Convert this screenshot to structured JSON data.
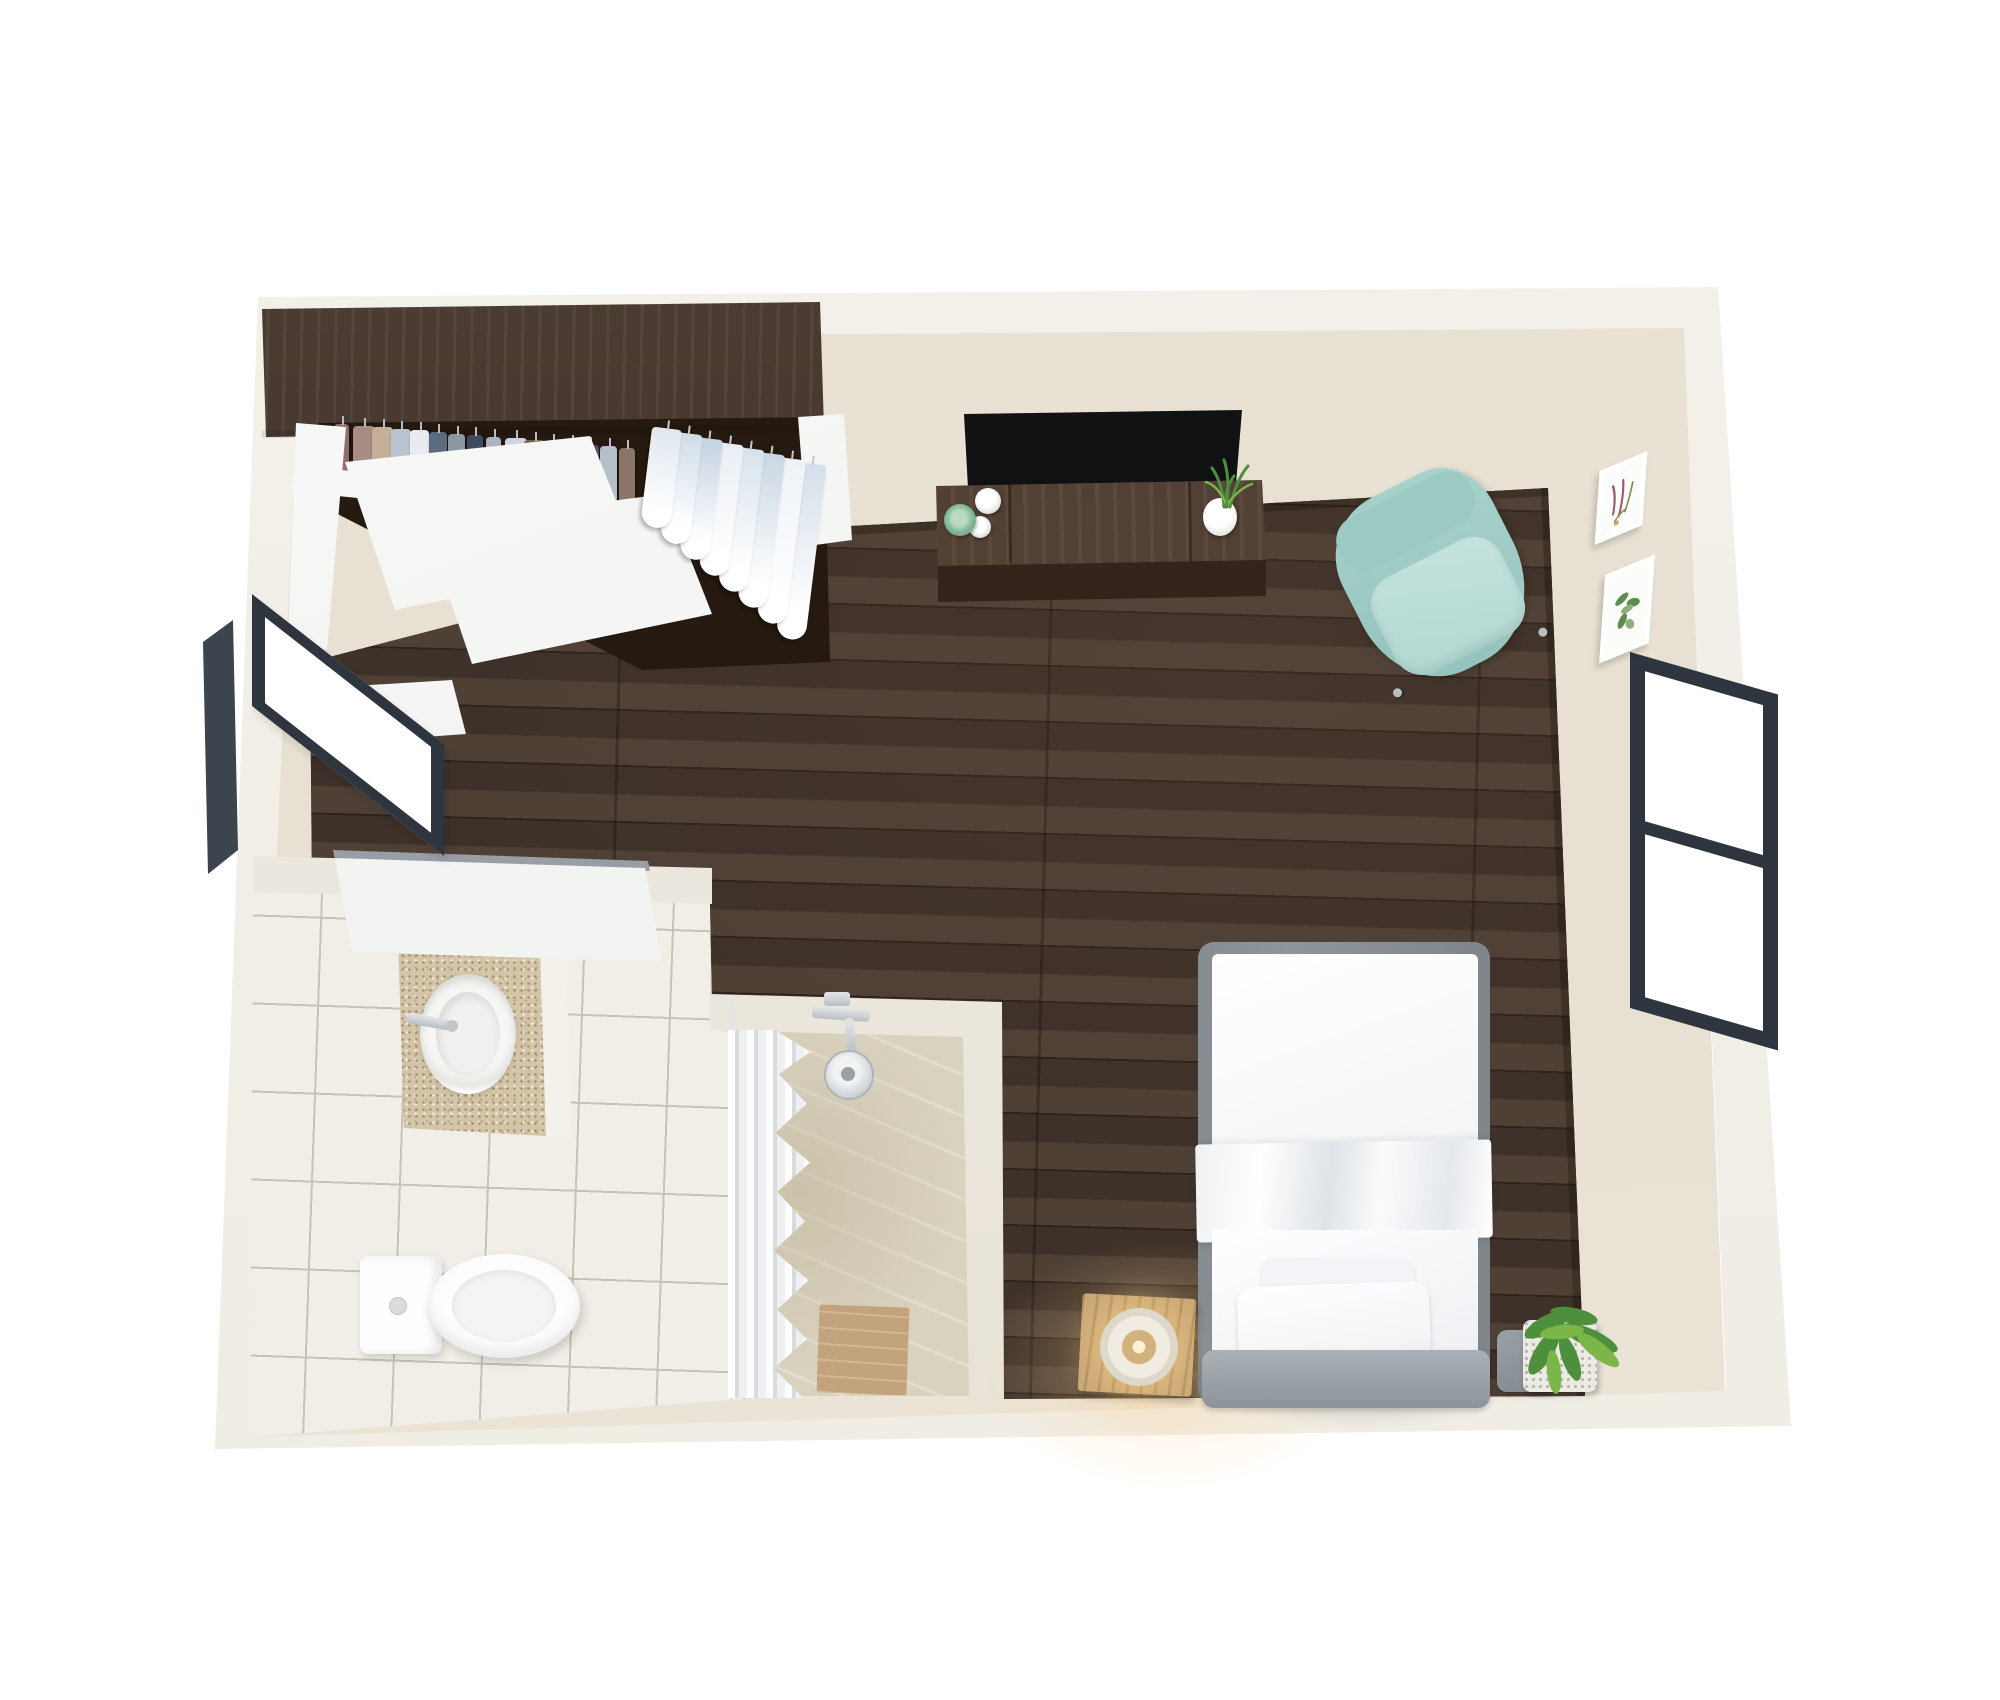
{
  "scene": {
    "type": "3d-floor-plan",
    "title": "Studio Apartment 3D Floor Plan",
    "view": "top-down 3D render, cutaway walls",
    "background": "#ffffff"
  },
  "palette": {
    "wall_top": "#f4f1ea",
    "wall_face": "#e8e0d2",
    "wood_floor": "#46372e",
    "wood_floor_dark": "#2f241d",
    "closet_wood": "#3c2c20",
    "console_wood": "#4a3729",
    "console_front": "#36281d",
    "tv_black": "#0b0c0d",
    "tile": "#f1eee7",
    "tile_grout": "#c8c2b4",
    "marble": "#d9d2bf",
    "armchair": "#a9d3cd",
    "armchair_seat": "#c6e3dd",
    "bed_frame_gray": "#8e959b",
    "headboard_gray": "#9aa2a9",
    "linen_white": "#fbfcfd",
    "lamp_wood": "#c8a876",
    "lamp_glow": "#ffd9a0",
    "plant_green": "#4e8f3c",
    "plant_green_light": "#7ab648",
    "window_frame": "#2e353e",
    "curtain_gray": "#d7dbde",
    "porcelain": "#fdfdfd",
    "cup_green": "#7fb89a",
    "counter_speckle": "#c7b292"
  },
  "rooms": [
    {
      "name": "Bedroom / living area",
      "floor": "dark walnut planks"
    },
    {
      "name": "Bathroom",
      "floor": "white ceramic tile"
    },
    {
      "name": "Walk-in shower",
      "floor": "beige marble"
    },
    {
      "name": "Wardrobe closet",
      "detail": "open closet with hanging rail and sliding doors"
    }
  ],
  "furniture": {
    "wardrobe": {
      "label": "Open wardrobe with hanging clothes"
    },
    "sliding_doors": {
      "label": "White sliding closet doors (ajar)"
    },
    "tv": {
      "label": "Flat-screen TV"
    },
    "tv_console": {
      "label": "Walnut TV console"
    },
    "candles": {
      "label": "Candles and green cup on console"
    },
    "console_plant": {
      "label": "Potted plant on console"
    },
    "armchair": {
      "label": "Mint green armchair"
    },
    "bed": {
      "label": "Single bed with white linens"
    },
    "pillows": {
      "label": "White pillows"
    },
    "headboard": {
      "label": "Gray upholstered headboard"
    },
    "nightstand_lamp": {
      "label": "Wooden cube side table with glowing lamp"
    },
    "floor_plant": {
      "label": "Potted plant beside bed"
    },
    "toilet": {
      "label": "Toilet"
    },
    "sink": {
      "label": "Vanity sink with speckled granite counter"
    },
    "shower": {
      "label": "Walk-in shower with curtain, shower head and wood bench"
    },
    "bathroom_door": {
      "label": "Open bathroom door"
    },
    "window_shelf": {
      "label": "White shelf below left window"
    },
    "window_left": {
      "label": "Window in left wall"
    },
    "window_right": {
      "label": "Window in right wall"
    },
    "wall_art_1": {
      "label": "Framed botanical print (red/plum)"
    },
    "wall_art_2": {
      "label": "Framed botanical print (green)"
    }
  },
  "closet": {
    "hanging_items": [
      "#8f6f6a",
      "#a88d84",
      "#c4b098",
      "#b9c4d1",
      "#e8ebef",
      "#5d6b80",
      "#8d97a2",
      "#3f4c60",
      "#aab4bf",
      "#cdd6e0",
      "#74614f",
      "#9aa6b4",
      "#e3e7ec",
      "#4a5568",
      "#b5bfc9",
      "#8a7668"
    ],
    "folded_shirts": [
      "#dfe7ee",
      "#cfdce8",
      "#c3d2e2",
      "#e9eef3",
      "#d8e2ec",
      "#c9d6e4",
      "#eef2f6",
      "#d4dfea"
    ]
  }
}
